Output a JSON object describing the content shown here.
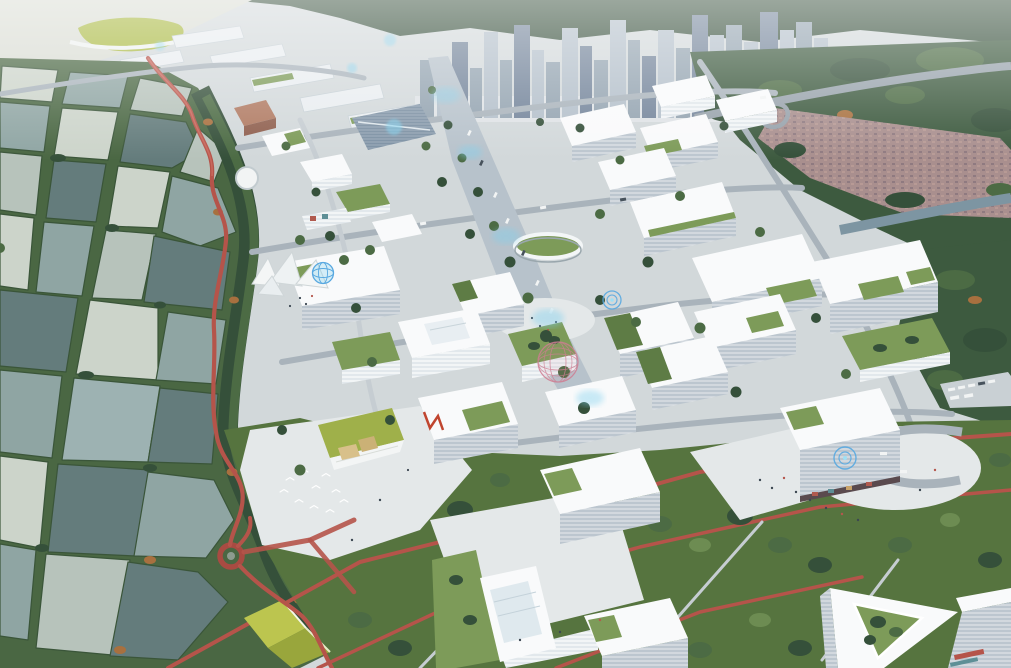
{
  "scene": {
    "type": "architectural-aerial-rendering",
    "viewpoint": "oblique aerial, looking north",
    "subject": "innovation-campus masterplan beside a wetland fishpond park",
    "regions": [
      {
        "name": "wetland-pond-grid",
        "label": "fishponds with green bunds"
      },
      {
        "name": "red-boardwalk",
        "label": "elevated winding red boardwalk with spiral lookout tower"
      },
      {
        "name": "campus-core",
        "label": "white mid-rise offices with overhanging flat roofs and green roof terraces"
      },
      {
        "name": "central-boulevard",
        "label": "tree-lined boulevard with holographic projections"
      },
      {
        "name": "city-skyline",
        "label": "hazy high-rise towers and hills"
      },
      {
        "name": "urban-village",
        "label": "mottled red-roof district with elevated highway and canal"
      },
      {
        "name": "linear-park",
        "label": "dense tree park with red jogging paths and egrets"
      }
    ]
  },
  "palette": {
    "pave": "#d2d8da",
    "plaza": "#e4e8e9",
    "road": "#a9b3bb",
    "road-light": "#c6cdd2",
    "boulevard": "#b7c2cb",
    "roof-white": "#f9fafb",
    "facade-light": "#e2e8ec",
    "facade-shadow": "#bcc6cf",
    "glass": "#7b8fa2",
    "green-roof": "#7d9b59",
    "green-roof-dark": "#5e7c45",
    "grass": "#8aa862",
    "tree": "#4c6b44",
    "tree-light": "#6d8c52",
    "tree-dark": "#35503a",
    "autumn": "#a8703f",
    "hedge": "#4a6743",
    "hedge-dark": "#3a5539",
    "wet-base": "#4a6743",
    "pond-silver": "#ccd4ca",
    "pond-pale": "#b7c3bb",
    "pond-mid": "#8fa5a3",
    "pond-dark": "#647c7c",
    "pond-blue": "#9db2b2",
    "boardwalk": "#b5544a",
    "boardwalk-light": "#c8685c",
    "hill": "#37503c",
    "water-far": "#d9dcd3",
    "tower-light": "#b3bfca",
    "tower-mid": "#93a3b0",
    "tower-dark": "#73849a",
    "terrace-white": "#e9edf0",
    "village-roof": "#a98f8e",
    "village-roof-dark": "#8f7a80",
    "forest": "#3d5a3f",
    "forest-dark": "#2e4733",
    "canal": "#7d95a2",
    "glow-cyan": "#7fd0ee",
    "glow-blue": "#58a8e0",
    "holo-pink": "#cf7d92",
    "chartreuse": "#bcc54f",
    "chartreuse-dark": "#99a63c",
    "lawn-roof": "#9fb04a",
    "tan-roof": "#d8c08a",
    "people": "#3c4752",
    "red-sculpt": "#c0452f",
    "shop-red": "#b05a4e",
    "shop-teal": "#5e8f96"
  }
}
